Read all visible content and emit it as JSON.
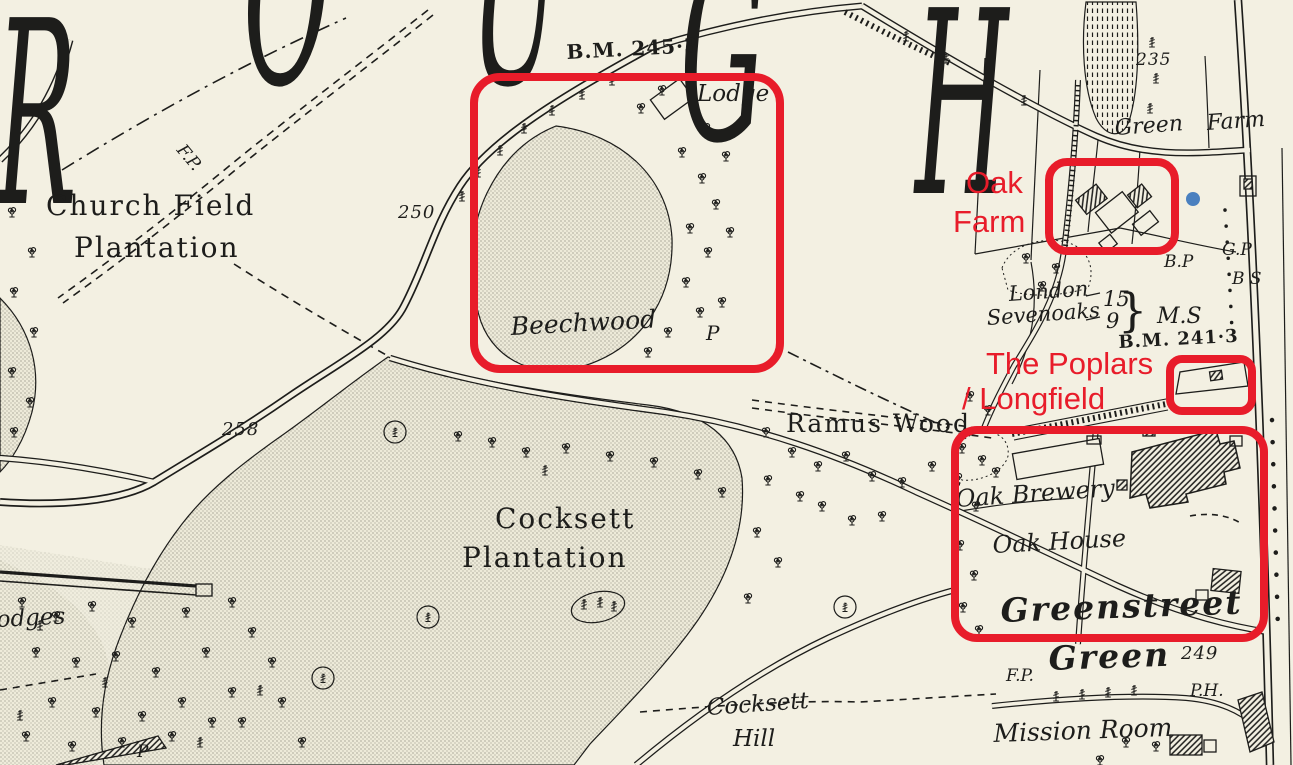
{
  "map": {
    "colors": {
      "background": "#f3f0e2",
      "ink": "#1d1d1b",
      "annotation_red": "#e81c2a",
      "marker_blue": "#4a80bf"
    },
    "title_fragment_letters": [
      {
        "ch": "R",
        "x": -4,
        "top": -12
      },
      {
        "ch": "O",
        "x": 243,
        "top": -132
      },
      {
        "ch": "U",
        "x": 470,
        "top": -132
      },
      {
        "ch": "G",
        "x": 680,
        "top": -76
      },
      {
        "ch": "H",
        "x": 915,
        "top": -22
      }
    ]
  },
  "map_labels": [
    {
      "text": "B.M. 245·3",
      "x": 566,
      "y": 42,
      "size": 20,
      "style": "bm",
      "rot": -3
    },
    {
      "text": "Lodge",
      "x": 697,
      "y": 82,
      "size": 23,
      "style": "it",
      "rot": 0
    },
    {
      "text": "F.P.",
      "x": 186,
      "y": 142,
      "size": 17,
      "style": "it",
      "rot": 50
    },
    {
      "text": "Church Field",
      "x": 46,
      "y": 191,
      "size": 28,
      "style": "rm",
      "rot": 0
    },
    {
      "text": "Plantation",
      "x": 74,
      "y": 233,
      "size": 28,
      "style": "rm",
      "rot": 0
    },
    {
      "text": "250",
      "x": 398,
      "y": 204,
      "size": 18,
      "style": "num",
      "rot": 0
    },
    {
      "text": "258",
      "x": 222,
      "y": 421,
      "size": 18,
      "style": "num",
      "rot": 0
    },
    {
      "text": "235",
      "x": 1136,
      "y": 52,
      "size": 17,
      "style": "num",
      "rot": 0
    },
    {
      "text": "Beechwood",
      "x": 510,
      "y": 314,
      "size": 25,
      "style": "it",
      "rot": -3
    },
    {
      "text": "P",
      "x": 706,
      "y": 323,
      "size": 20,
      "style": "it",
      "rot": 0
    },
    {
      "text": "Green",
      "x": 1114,
      "y": 117,
      "size": 22,
      "style": "it",
      "rot": -4
    },
    {
      "text": "Farm",
      "x": 1206,
      "y": 112,
      "size": 22,
      "style": "it",
      "rot": -4
    },
    {
      "text": "G.P",
      "x": 1222,
      "y": 242,
      "size": 17,
      "style": "it",
      "rot": 0
    },
    {
      "text": "B.P",
      "x": 1164,
      "y": 254,
      "size": 17,
      "style": "it",
      "rot": 0
    },
    {
      "text": "B S",
      "x": 1232,
      "y": 271,
      "size": 17,
      "style": "it",
      "rot": 0
    },
    {
      "text": "London",
      "x": 1008,
      "y": 283,
      "size": 21,
      "style": "it",
      "rot": -4
    },
    {
      "text": "15",
      "x": 1103,
      "y": 288,
      "size": 21,
      "style": "it",
      "rot": 0
    },
    {
      "text": "Sevenoaks",
      "x": 986,
      "y": 307,
      "size": 21,
      "style": "it",
      "rot": -4
    },
    {
      "text": "9",
      "x": 1106,
      "y": 310,
      "size": 21,
      "style": "it",
      "rot": 0
    },
    {
      "text": "}",
      "x": 1118,
      "y": 286,
      "size": 46,
      "style": "brace",
      "rot": 0
    },
    {
      "text": "M.S",
      "x": 1157,
      "y": 305,
      "size": 22,
      "style": "it",
      "rot": 0
    },
    {
      "text": "B.M. 241·3",
      "x": 1118,
      "y": 334,
      "size": 18,
      "style": "bm",
      "rot": -3
    },
    {
      "text": "Ramus Wood",
      "x": 786,
      "y": 411,
      "size": 25,
      "style": "rm",
      "rot": 0
    },
    {
      "text": "Oak Brewery",
      "x": 955,
      "y": 487,
      "size": 24,
      "style": "it",
      "rot": -4
    },
    {
      "text": "Oak House",
      "x": 992,
      "y": 533,
      "size": 24,
      "style": "it",
      "rot": -3
    },
    {
      "text": "Greenstreet",
      "x": 1000,
      "y": 594,
      "size": 33,
      "style": "big",
      "rot": -2
    },
    {
      "text": "Green",
      "x": 1048,
      "y": 642,
      "size": 33,
      "style": "big",
      "rot": -2
    },
    {
      "text": "249",
      "x": 1181,
      "y": 645,
      "size": 18,
      "style": "num",
      "rot": 0
    },
    {
      "text": "F.P.",
      "x": 1006,
      "y": 668,
      "size": 17,
      "style": "it",
      "rot": 0
    },
    {
      "text": "P.H.",
      "x": 1190,
      "y": 683,
      "size": 17,
      "style": "it",
      "rot": 0
    },
    {
      "text": "Mission Room",
      "x": 993,
      "y": 721,
      "size": 25,
      "style": "it",
      "rot": -2
    },
    {
      "text": "Cocksett",
      "x": 495,
      "y": 504,
      "size": 28,
      "style": "rm",
      "rot": 0
    },
    {
      "text": "Plantation",
      "x": 462,
      "y": 543,
      "size": 28,
      "style": "rm",
      "rot": 0
    },
    {
      "text": "Cocksett",
      "x": 706,
      "y": 696,
      "size": 23,
      "style": "it",
      "rot": -4
    },
    {
      "text": "Hill",
      "x": 733,
      "y": 727,
      "size": 23,
      "style": "it",
      "rot": 0
    },
    {
      "text": "odges",
      "x": -4,
      "y": 608,
      "size": 23,
      "style": "it",
      "rot": -3
    },
    {
      "text": "P",
      "x": 137,
      "y": 744,
      "size": 17,
      "style": "it",
      "rot": 0
    }
  ],
  "annotations": {
    "boxes": [
      {
        "name": "beechwood-lodge-box",
        "x": 470,
        "y": 73,
        "w": 314,
        "h": 300,
        "radius": 30
      },
      {
        "name": "oak-farm-box",
        "x": 1045,
        "y": 158,
        "w": 134,
        "h": 97,
        "radius": 22
      },
      {
        "name": "poplars-longfield-box",
        "x": 1166,
        "y": 355,
        "w": 90,
        "h": 60,
        "radius": 16
      },
      {
        "name": "greenstreet-green-box",
        "x": 951,
        "y": 426,
        "w": 317,
        "h": 216,
        "radius": 26
      }
    ],
    "labels": [
      {
        "text": "Oak",
        "x": 966,
        "y": 167
      },
      {
        "text": "Farm",
        "x": 953,
        "y": 206
      },
      {
        "text": "The Poplars",
        "x": 986,
        "y": 348
      },
      {
        "text": "/ Longfield",
        "x": 962,
        "y": 383
      }
    ],
    "marker_dot": {
      "x": 1193,
      "y": 199
    }
  }
}
